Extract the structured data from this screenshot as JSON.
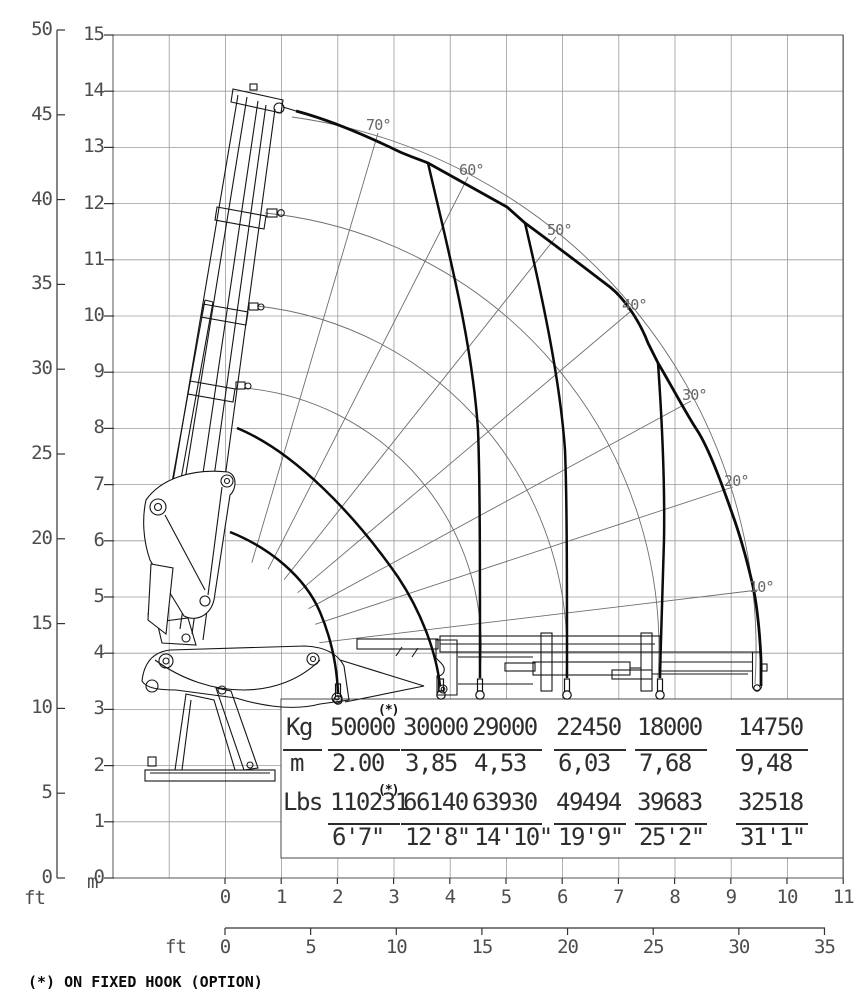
{
  "footnote": "(*) ON FIXED HOOK (OPTION)",
  "star_marker": "(*)",
  "axes": {
    "left_ft": {
      "unit": "ft",
      "ticks": [
        "0",
        "5",
        "10",
        "15",
        "20",
        "25",
        "30",
        "35",
        "40",
        "45",
        "50"
      ]
    },
    "left_m": {
      "unit": "m",
      "ticks": [
        "0",
        "1",
        "2",
        "3",
        "4",
        "5",
        "6",
        "7",
        "8",
        "9",
        "10",
        "11",
        "12",
        "13",
        "14",
        "15"
      ]
    },
    "bottom_m": {
      "unit": "m",
      "ticks": [
        "0",
        "1",
        "2",
        "3",
        "4",
        "5",
        "6",
        "7",
        "8",
        "9",
        "10",
        "11"
      ]
    },
    "bottom_ft": {
      "unit": "ft",
      "ticks": [
        "0",
        "5",
        "10",
        "15",
        "20",
        "25",
        "30",
        "35"
      ]
    }
  },
  "angle_labels": [
    "70°",
    "60°",
    "50°",
    "40°",
    "30°",
    "20°",
    "10°"
  ],
  "load_table": {
    "kg_label": "Kg",
    "m_label": "m",
    "lbs_label": "Lbs",
    "columns": [
      {
        "kg": "50000",
        "m": "2.00",
        "lbs": "110231",
        "ft": "6'7\"",
        "star": true
      },
      {
        "kg": "30000",
        "m": "3,85",
        "lbs": "66140",
        "ft": "12'8\"",
        "star": false
      },
      {
        "kg": "29000",
        "m": "4,53",
        "lbs": "63930",
        "ft": "14'10\"",
        "star": false
      },
      {
        "kg": "22450",
        "m": "6,03",
        "lbs": "49494",
        "ft": "19'9\"",
        "star": false
      },
      {
        "kg": "18000",
        "m": "7,68",
        "lbs": "39683",
        "ft": "25'2\"",
        "star": false
      },
      {
        "kg": "14750",
        "m": "9,48",
        "lbs": "32518",
        "ft": "31'1\"",
        "star": false
      }
    ]
  },
  "chart_data": {
    "type": "line",
    "title": "Crane lifting capacity diagram (outreach vs height envelope)",
    "x_axis": {
      "unit_primary": "m",
      "range_m": [
        0,
        11
      ],
      "unit_secondary": "ft",
      "range_ft": [
        0,
        35
      ]
    },
    "y_axis": {
      "unit_primary": "m",
      "range_m": [
        0,
        15
      ],
      "unit_secondary": "ft",
      "range_ft": [
        0,
        50
      ]
    },
    "grid": "1 m square grid, on",
    "legend_position": "none",
    "boom_angle_rays_deg": [
      70,
      60,
      50,
      40,
      30,
      20,
      10
    ],
    "capacity_steps": [
      {
        "outreach_m": 2.0,
        "outreach_ft_in": "6'7\"",
        "load_kg": 50000,
        "load_lbs": 110231,
        "note": "on fixed hook (option)"
      },
      {
        "outreach_m": 3.85,
        "outreach_ft_in": "12'8\"",
        "load_kg": 30000,
        "load_lbs": 66140
      },
      {
        "outreach_m": 4.53,
        "outreach_ft_in": "14'10\"",
        "load_kg": 29000,
        "load_lbs": 63930
      },
      {
        "outreach_m": 6.03,
        "outreach_ft_in": "19'9\"",
        "load_kg": 22450,
        "load_lbs": 49494
      },
      {
        "outreach_m": 7.68,
        "outreach_ft_in": "25'2\"",
        "load_kg": 18000,
        "load_lbs": 39683
      },
      {
        "outreach_m": 9.48,
        "outreach_ft_in": "31'1\"",
        "load_kg": 14750,
        "load_lbs": 32518
      }
    ],
    "envelope_max_height_m": 13.8,
    "envelope_max_outreach_m": 9.5,
    "boom_pivot_at_m": [
      0,
      4
    ]
  }
}
